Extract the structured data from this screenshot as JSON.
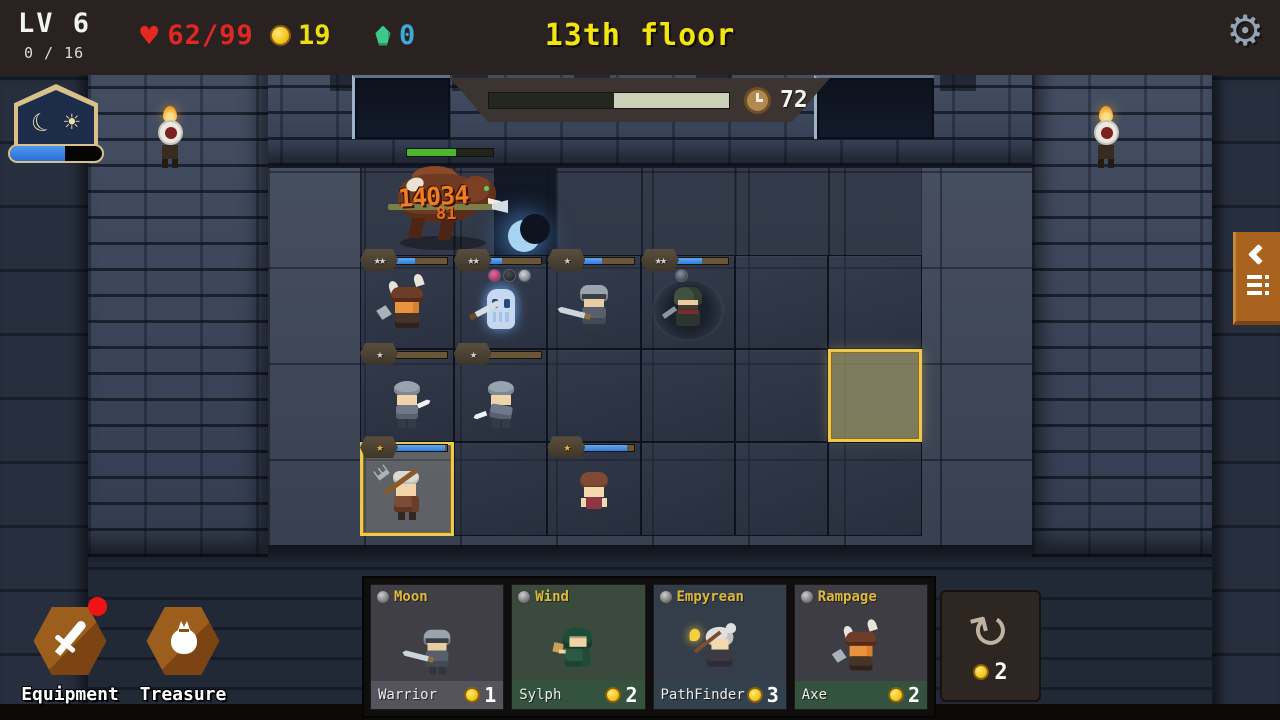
{
  "hud": {
    "level": "LV 6",
    "level_progress": "0 / 16",
    "hp": "62/99",
    "gold": "19",
    "essence": "0",
    "floor_title": "13th floor",
    "timer": "72",
    "timer_elapsed_fraction": 0.52,
    "daynight_fraction": 0.6
  },
  "icons": {
    "gear": "⚙",
    "heart": "♥",
    "moon": "☾",
    "sun": "☀",
    "refresh": "↻"
  },
  "colors": {
    "accent_gold": "#edc94e",
    "hp_bar_blue": "#2e7ee0",
    "timer_remaining": "#c9d2b8",
    "hp_text_red": "#e02822",
    "gold_text": "#ecdf12",
    "essence_text": "#3fa9d6",
    "title_yellow": "#f2e60e",
    "tab_orange": "#aa631e",
    "boss_hp_green": "#49b82d",
    "damage_orange": "#ef7d22"
  },
  "boss": {
    "damage_main": "14034",
    "damage_secondary": "81",
    "hp_fraction": 0.57
  },
  "grid": {
    "rows": 3,
    "cols": 6,
    "highlight_cell": {
      "row": 1,
      "col": 5
    }
  },
  "units": [
    {
      "type": "viking",
      "stars": "★★",
      "star_tier": "silver",
      "hp_fraction": 0.44,
      "row": 0,
      "col": 0,
      "items": []
    },
    {
      "type": "ghost",
      "stars": "★★",
      "star_tier": "silver",
      "hp_fraction": 0.34,
      "row": 0,
      "col": 1,
      "items": [
        "potion",
        "bomb",
        "dagger"
      ]
    },
    {
      "type": "knight",
      "stars": "★",
      "star_tier": "silver",
      "hp_fraction": 0.45,
      "row": 0,
      "col": 2,
      "items": []
    },
    {
      "type": "rogue",
      "stars": "★★",
      "star_tier": "silver",
      "hp_fraction": 0.55,
      "row": 0,
      "col": 3,
      "items": [
        "axe"
      ]
    },
    {
      "type": "soldier",
      "stars": "★",
      "star_tier": "silver",
      "hp_fraction": 0.05,
      "row": 1,
      "col": 0,
      "items": []
    },
    {
      "type": "soldier2",
      "stars": "★",
      "star_tier": "silver",
      "hp_fraction": 0.13,
      "row": 1,
      "col": 1,
      "items": []
    },
    {
      "type": "farmer",
      "stars": "★",
      "star_tier": "gold",
      "hp_fraction": 0.97,
      "row": 2,
      "col": 0,
      "items": [],
      "selected": true
    },
    {
      "type": "girl",
      "stars": "★",
      "star_tier": "gold",
      "hp_fraction": 0.88,
      "row": 2,
      "col": 2,
      "items": []
    }
  ],
  "bottom_left": {
    "equipment_label": "Equipment",
    "treasure_label": "Treasure",
    "equipment_has_notification": true
  },
  "shop": {
    "cards": [
      {
        "tag": "Moon",
        "unit_name": "Warrior",
        "price": "1",
        "sprite": "knight"
      },
      {
        "tag": "Wind",
        "unit_name": "Sylph",
        "price": "2",
        "sprite": "sylph"
      },
      {
        "tag": "Empyrean",
        "unit_name": "PathFinder",
        "price": "3",
        "sprite": "pathfinder"
      },
      {
        "tag": "Rampage",
        "unit_name": "Axe",
        "price": "2",
        "sprite": "viking"
      }
    ],
    "reroll_cost": "2"
  }
}
